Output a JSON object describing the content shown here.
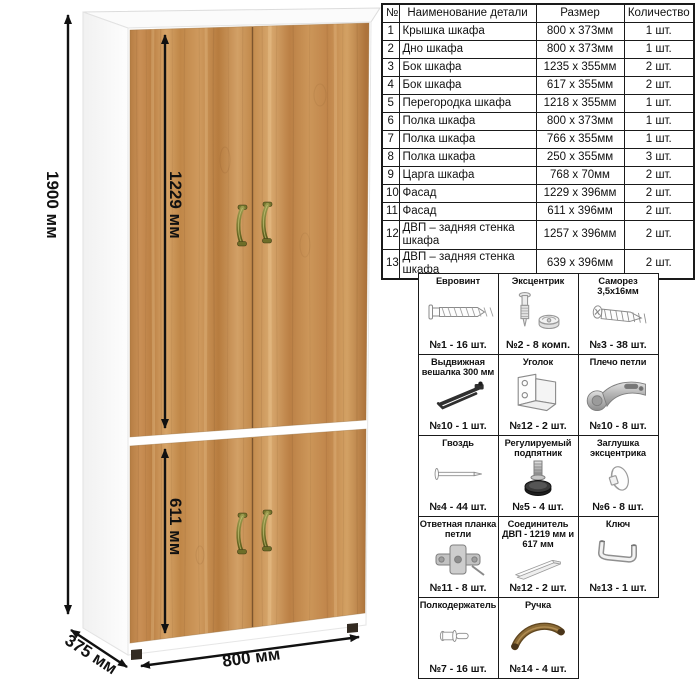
{
  "colors": {
    "wood": "#c6905a",
    "carcass_white": "#ffffff",
    "handle_bronze": "#8f9146",
    "dimension_lines": "#111111",
    "table_border": "#1a1a1a"
  },
  "dimensions": {
    "height": "1900 мм",
    "upper_door_height": "1229 мм",
    "lower_door_height": "611 мм",
    "width": "800 мм",
    "depth": "375 мм"
  },
  "parts_table": {
    "headers": [
      "№",
      "Наименование детали",
      "Размер",
      "Количество"
    ],
    "rows": [
      [
        "1",
        "Крышка шкафа",
        "800 х 373мм",
        "1 шт."
      ],
      [
        "2",
        "Дно шкафа",
        "800 х 373мм",
        "1 шт."
      ],
      [
        "3",
        "Бок шкафа",
        "1235 х 355мм",
        "2 шт."
      ],
      [
        "4",
        "Бок шкафа",
        "617 х 355мм",
        "2 шт."
      ],
      [
        "5",
        "Перегородка шкафа",
        "1218 х 355мм",
        "1 шт."
      ],
      [
        "6",
        "Полка шкафа",
        "800 х 373мм",
        "1 шт."
      ],
      [
        "7",
        "Полка шкафа",
        "766 х 355мм",
        "1 шт."
      ],
      [
        "8",
        "Полка шкафа",
        "250 х 355мм",
        "3 шт."
      ],
      [
        "9",
        "Царга шкафа",
        "768 х 70мм",
        "2 шт."
      ],
      [
        "10",
        "Фасад",
        "1229 х 396мм",
        "2 шт."
      ],
      [
        "11",
        "Фасад",
        "611 х 396мм",
        "2 шт."
      ],
      [
        "12",
        "ДВП – задняя стенка шкафа",
        "1257 х 396мм",
        "2 шт."
      ],
      [
        "13",
        "ДВП – задняя стенка шкафа",
        "639 х 396мм",
        "2 шт."
      ]
    ]
  },
  "hardware": {
    "items": [
      {
        "name": "Евровинт",
        "qty": "№1 - 16 шт.",
        "icon": "confirmat-screw-icon"
      },
      {
        "name": "Эксцентрик",
        "qty": "№2 - 8 комп.",
        "icon": "cam-lock-icon"
      },
      {
        "name": "Саморез 3,5х16мм",
        "qty": "№3 - 38 шт.",
        "icon": "self-tapping-screw-icon"
      },
      {
        "name": "Выдвижная вешалка 300 мм",
        "qty": "№10 - 1 шт.",
        "icon": "pull-out-hanger-icon"
      },
      {
        "name": "Уголок",
        "qty": "№12 - 2 шт.",
        "icon": "corner-bracket-icon"
      },
      {
        "name": "Плечо петли",
        "qty": "№10 - 8 шт.",
        "icon": "hinge-arm-icon"
      },
      {
        "name": "Гвоздь",
        "qty": "№4 - 44 шт.",
        "icon": "nail-icon"
      },
      {
        "name": "Регулируемый подпятник",
        "qty": "№5 - 4 шт.",
        "icon": "adjustable-foot-icon"
      },
      {
        "name": "Заглушка эксцентрика",
        "qty": "№6 - 8 шт.",
        "icon": "cam-cover-icon"
      },
      {
        "name": "Ответная планка петли",
        "qty": "№11 - 8 шт.",
        "icon": "hinge-mounting-plate-icon"
      },
      {
        "name": "Соединитель ДВП - 1219 мм и 617 мм",
        "qty": "№12 - 2 шт.",
        "icon": "hdf-connector-strip-icon"
      },
      {
        "name": "Ключ",
        "qty": "№13 - 1 шт.",
        "icon": "hex-key-icon"
      },
      {
        "name": "Полкодержатель",
        "qty": "№7 - 16 шт.",
        "icon": "shelf-pin-icon"
      },
      {
        "name": "Ручка",
        "qty": "№14 - 4 шт.",
        "icon": "door-handle-icon"
      }
    ]
  }
}
